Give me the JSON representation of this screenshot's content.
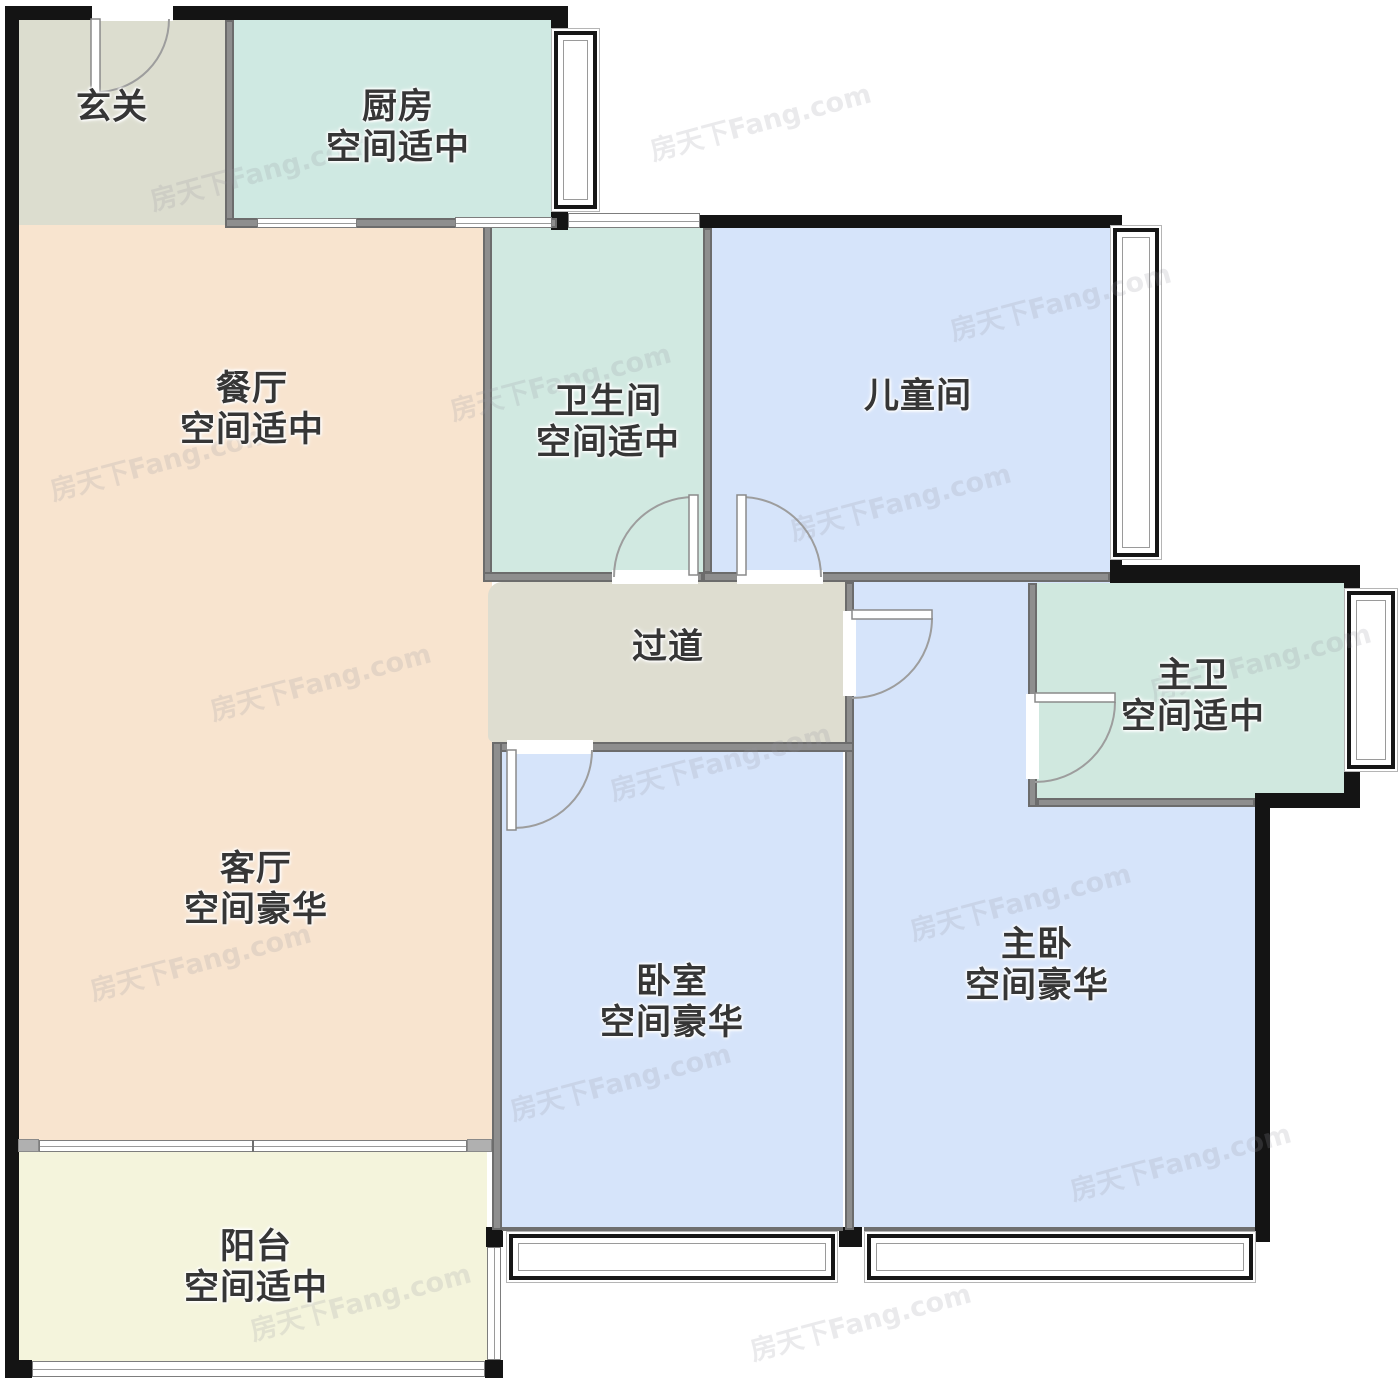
{
  "plan_title": "户型图",
  "watermark": {
    "text": "房天下Fang.com"
  },
  "colors": {
    "wall_exterior": "#141414",
    "wall_interior": "#8e8e8e",
    "room_neutral_gray": "#dcddcf",
    "room_mint": "#d0e9e2",
    "room_peach": "#f8e4cf",
    "room_blue": "#d6e4fa",
    "room_yellow": "#f4f4dc",
    "label_text": "#363636"
  },
  "rooms": [
    {
      "id": "entry-hall",
      "name": "玄关",
      "subtitle": "",
      "color": "#dcddcf"
    },
    {
      "id": "kitchen",
      "name": "厨房",
      "subtitle": "空间适中",
      "color": "#cfe9e2"
    },
    {
      "id": "dining-room",
      "name": "餐厅",
      "subtitle": "空间适中",
      "color": "#f8e4cf"
    },
    {
      "id": "bathroom",
      "name": "卫生间",
      "subtitle": "空间适中",
      "color": "#d1e9e1"
    },
    {
      "id": "kids-room",
      "name": "儿童间",
      "subtitle": "",
      "color": "#d6e4fa"
    },
    {
      "id": "hallway",
      "name": "过道",
      "subtitle": "",
      "color": "#deddd0"
    },
    {
      "id": "master-bathroom",
      "name": "主卫",
      "subtitle": "空间适中",
      "color": "#d0e8df"
    },
    {
      "id": "living-room",
      "name": "客厅",
      "subtitle": "空间豪华",
      "color": "#f8e4cf"
    },
    {
      "id": "bedroom",
      "name": "卧室",
      "subtitle": "空间豪华",
      "color": "#d6e4fa"
    },
    {
      "id": "master-bedroom",
      "name": "主卧",
      "subtitle": "空间豪华",
      "color": "#d6e4fa"
    },
    {
      "id": "balcony",
      "name": "阳台",
      "subtitle": "空间适中",
      "color": "#f4f4dc"
    }
  ]
}
